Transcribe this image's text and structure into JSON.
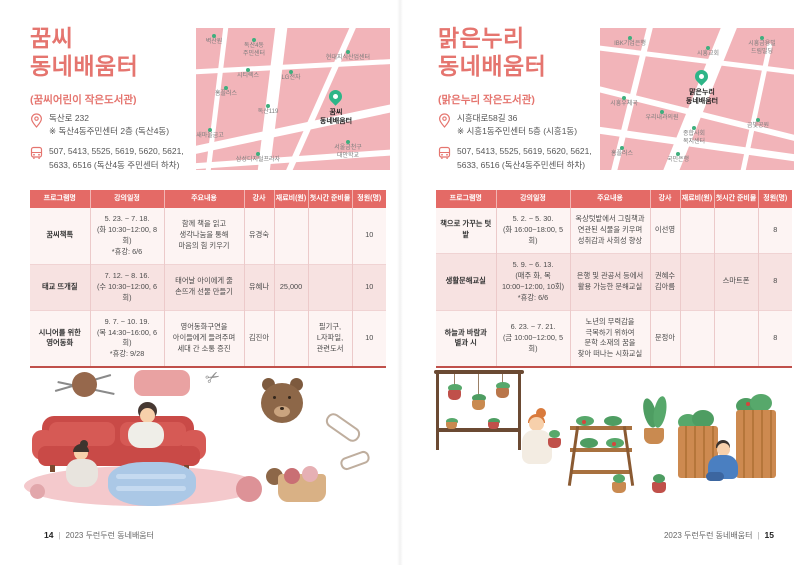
{
  "theme": {
    "accent": "#e5756f",
    "table_header_bg": "#e46a66",
    "map_bg": "#f2b4b9",
    "map_green": "#3faf7e"
  },
  "pages": [
    {
      "title": "꿈씨\n동네배움터",
      "subtitle": "(꿈씨어린이 작은도서관)",
      "address": {
        "line1": "독산로 232",
        "line2": "※ 독산4동주민센터 2층 (독산4동)"
      },
      "bus": {
        "line1": "507, 5413, 5525, 5619, 5620, 5621,",
        "line2": "5633, 6516 (독산4동 주민센터 하차)"
      },
      "map": {
        "marker_label": "꿈씨\n동네배움터",
        "places": [
          "벽산원",
          "독산4동\n주민센터",
          "시티렉스",
          "LG전자",
          "홈플러스",
          "독산119",
          "새마을금고",
          "삼성디지털프라자",
          "현대지식산업센터",
          "서울금천구\n대안학교"
        ]
      },
      "table": {
        "headers": [
          "프로그램명",
          "강의일정",
          "주요내용",
          "강사",
          "재료비(원)",
          "첫시간 준비물",
          "정원(명)"
        ],
        "rows": [
          [
            "꿈씨책톡",
            "5. 23. ~ 7. 18.\n(화 10:30~12:00, 8회)\n*휴강: 6/6",
            "함께 책을 읽고\n생각나눔을 통해\n마음의 힘 키우기",
            "유경숙",
            "",
            "",
            "10"
          ],
          [
            "태교 뜨개질",
            "7. 12. ~ 8. 16.\n(수 10:30~12:00, 6회)",
            "태어날 아이에게 줄\n손뜨개 선물 만들기",
            "유혜나",
            "25,000",
            "",
            "10"
          ],
          [
            "시니어를 위한\n영어동화",
            "9. 7. ~ 10. 19.\n(목 14:30~16:00, 6회)\n*휴강: 9/28",
            "영어동화구연을\n아이들에게 들려주며\n세대 간 소통 증진",
            "김진아",
            "",
            "필기구,\nL자파일,\n관련도서",
            "10"
          ]
        ]
      }
    },
    {
      "title": "맑은누리\n동네배움터",
      "subtitle": "(맑은누리 작은도서관)",
      "address": {
        "line1": "시흥대로58길 36",
        "line2": "※ 시흥1동주민센터 5층 (시흥1동)"
      },
      "bus": {
        "line1": "507, 5413, 5525, 5619, 5620, 5621,",
        "line2": "5633, 6516 (독산4동주민센터 하차)"
      },
      "map": {
        "marker_label": "맑은누리\n동네배움터",
        "places": [
          "IBK기업은행",
          "시흥교회",
          "시흥금융빌\n드림빌딩",
          "시흥우체국",
          "우리내과의원",
          "종합사회\n복지센터",
          "금빛공원",
          "홈플러스",
          "국민은행"
        ]
      },
      "table": {
        "headers": [
          "프로그램명",
          "강의일정",
          "주요내용",
          "강사",
          "재료비(원)",
          "첫시간 준비물",
          "정원(명)"
        ],
        "rows": [
          [
            "책으로 가꾸는 텃밭",
            "5. 2. ~ 5. 30.\n(화 16:00~18:00, 5회)",
            "옥상텃밭에서 그림책과\n연관된 식물을 키우며\n성취감과 사회성 향상",
            "이선영",
            "",
            "",
            "8"
          ],
          [
            "생활문해교실",
            "5. 9. ~ 6. 13.\n(매주 화, 목\n10:00~12:00, 10회)\n*휴강: 6/6",
            "은행 및 관공서 등에서\n활용 가능한 문해교실",
            "권혜수\n김아름",
            "",
            "스마트폰",
            "8"
          ],
          [
            "하늘과 바람과\n별과 시",
            "6. 23. ~ 7. 21.\n(금 10:00~12:00, 5회)",
            "노년의 무력감을\n극복하기 위하여\n문학 소재의 꿈을\n찾아 떠나는 시화교실",
            "문정아",
            "",
            "",
            "8"
          ]
        ]
      }
    }
  ],
  "footer": {
    "left_page_number": "14",
    "left_text": "2023 두런두런 동네배움터",
    "right_text": "2023 두런두런 동네배움터",
    "right_page_number": "15"
  }
}
